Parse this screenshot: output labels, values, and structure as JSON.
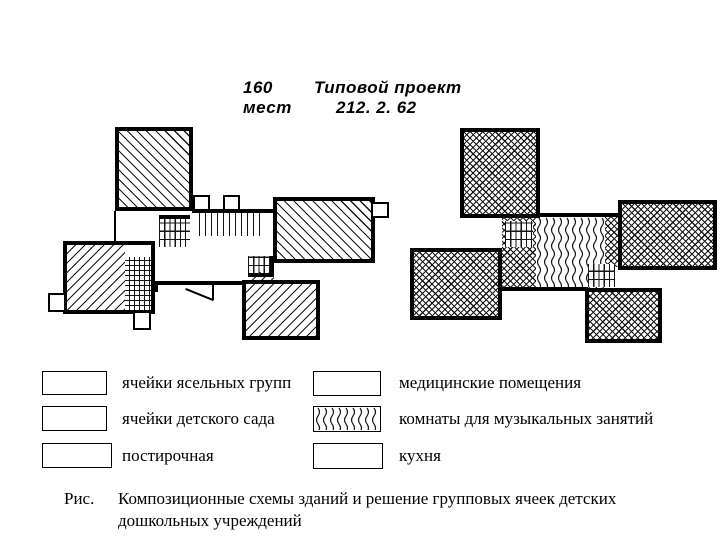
{
  "page": {
    "background": "#ffffff",
    "ink": "#000000"
  },
  "header": {
    "capacity_value": "160",
    "capacity_unit": "мест",
    "project_title": "Типовой проект",
    "project_number": "212. 2. 62"
  },
  "legend": {
    "items": [
      {
        "label": "ячейки ясельных групп",
        "pattern": "diagonal-back-hatch"
      },
      {
        "label": "ячейки детского сада",
        "pattern": "crosshatch"
      },
      {
        "label": "постирочная",
        "pattern": "grid-hatch"
      },
      {
        "label": "медицинские помещения",
        "pattern": "vertical-lines-hatch"
      },
      {
        "label": "комнаты для музыкальных занятий",
        "pattern": "wavy-lines-hatch"
      },
      {
        "label": "кухня",
        "pattern": "diagonal-forward-hatch"
      }
    ]
  },
  "caption": {
    "prefix": "Рис.",
    "text": "Композиционные схемы зданий и решение групповых ячеек детских дошкольных учреждений"
  }
}
